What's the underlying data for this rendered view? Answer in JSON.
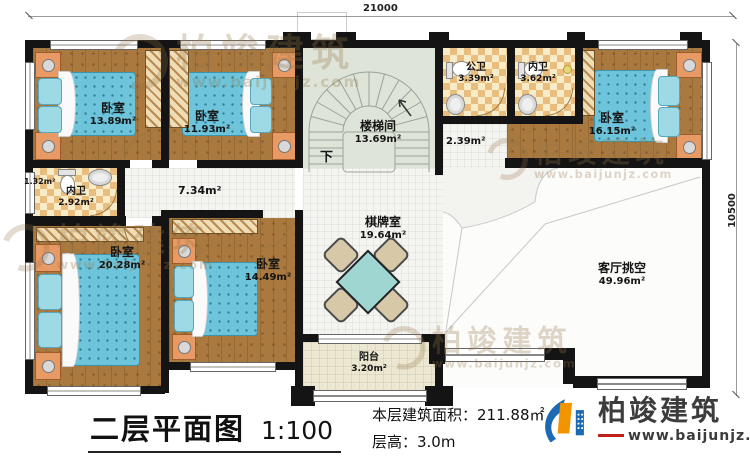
{
  "plan": {
    "dim_width": "21000",
    "dim_height": "10500",
    "rooms": [
      {
        "id": "bedroom-top-left",
        "name": "卧室",
        "area": "13.89m²"
      },
      {
        "id": "bedroom-top-mid",
        "name": "卧室",
        "area": "11.93m²"
      },
      {
        "id": "stairwell",
        "name": "楼梯间",
        "area": "13.69m²"
      },
      {
        "id": "public-bathroom",
        "name": "公卫",
        "area": "3.39m²"
      },
      {
        "id": "ensuite-bathroom-top",
        "name": "内卫",
        "area": "3.62m²"
      },
      {
        "id": "bedroom-top-right",
        "name": "卧室",
        "area": "16.15m²"
      },
      {
        "id": "ensuite-bathroom-left",
        "name": "内卫",
        "area": "2.92m²"
      },
      {
        "id": "bedroom-bottom-left",
        "name": "卧室",
        "area": "20.28m²"
      },
      {
        "id": "bedroom-bottom-mid",
        "name": "卧室",
        "area": "14.49m²"
      },
      {
        "id": "game-room",
        "name": "棋牌室",
        "area": "19.64m²"
      },
      {
        "id": "balcony",
        "name": "阳台",
        "area": "3.20m²"
      },
      {
        "id": "living-void",
        "name": "客厅挑空",
        "area": "49.96m²"
      }
    ],
    "annotations": {
      "closet_area": "1.32m²",
      "hallway_area": "7.34m²",
      "landing_area": "2.39m²",
      "stairs_down": "下"
    }
  },
  "footer": {
    "title": "二层平面图",
    "scale": "1:100",
    "area_line": "本层建筑面积：211.88㎡",
    "height_line": "层高：3.0m"
  },
  "brand": {
    "name": "柏竣建筑",
    "url": "www.baijunjz.com"
  },
  "watermark": {
    "name": "柏竣建筑",
    "url": "www.baijunjz.com"
  }
}
